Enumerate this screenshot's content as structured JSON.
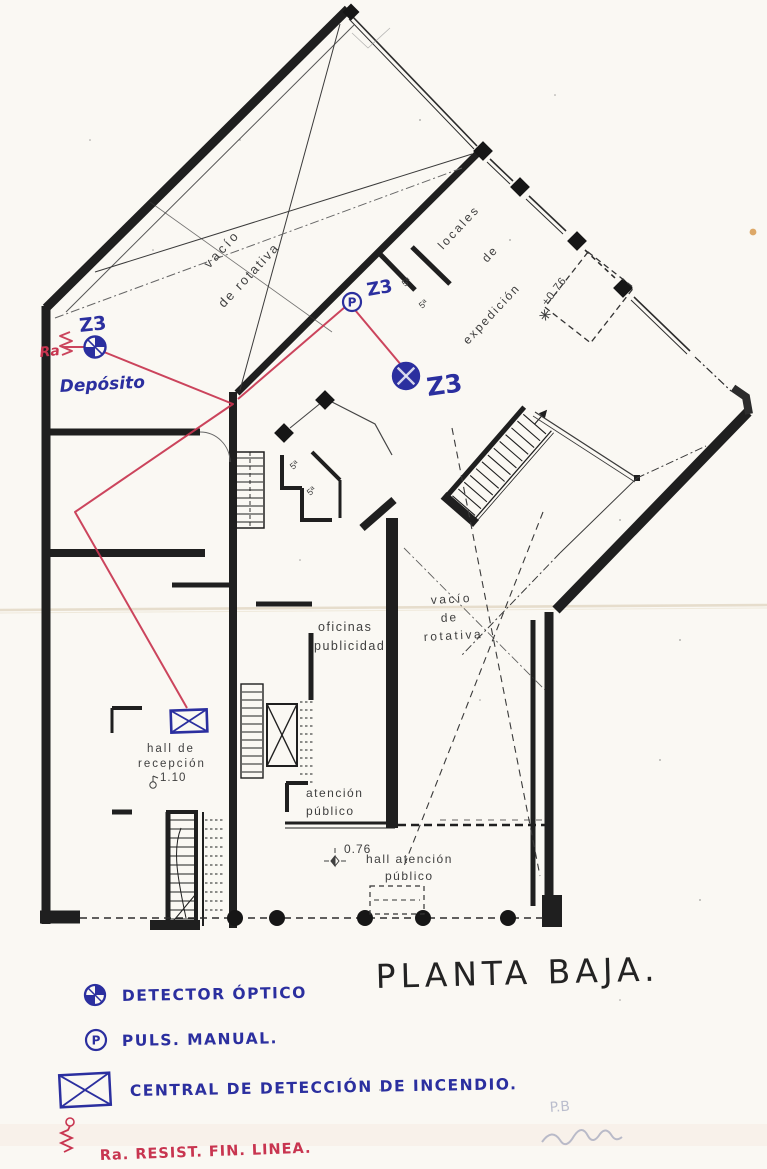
{
  "document": {
    "title": "PLANTA BAJA.",
    "pencil_note": "P.B"
  },
  "rooms": {
    "rotary_void_top": {
      "line1": "vacío",
      "line2": "de rotativa"
    },
    "expedition": {
      "line1": "locales",
      "line2": "de",
      "line3": "expedición",
      "level": "+0.76"
    },
    "advertising_offices": {
      "line1": "oficinas",
      "line2": "publicidad"
    },
    "rotary_void_right": {
      "line1": "vacío",
      "line2": "de",
      "line3": "rotativa"
    },
    "reception_hall": {
      "line1": "hall de",
      "line2": "recepción",
      "level": "1.10"
    },
    "public_attention": {
      "line1": "atención",
      "line2": "público"
    },
    "public_attention_hall": {
      "line1": "hall atención",
      "line2": "público",
      "level": "0.76"
    },
    "room_tags": [
      "5ª",
      "5ª",
      "5ª",
      "5ª"
    ]
  },
  "annotations": {
    "zone_detector_deposito": "Z3",
    "zone_callpoint": "Z3",
    "zone_detector_main": "Z3",
    "deposito_label": "Depósito",
    "resistor_tag": "Ra",
    "callpoint_letter": "P"
  },
  "legend": {
    "title_items": [
      {
        "symbol": "optical-detector-icon",
        "label": "DETECTOR ÓPTICO"
      },
      {
        "symbol": "manual-callpoint-icon",
        "label": "PULS. MANUAL."
      },
      {
        "symbol": "fire-panel-icon",
        "label": "CENTRAL DE DETECCIÓN DE INCENDIO."
      },
      {
        "symbol": "end-of-line-resistor-icon",
        "label": "Ra. RESIST. FIN. LINEA."
      }
    ],
    "callpoint_letter": "P"
  },
  "colors": {
    "ink_blue": "#2b2f9f",
    "wire_red": "#c83550",
    "wall_black": "#1f1f1f",
    "paper": "#faf8f3",
    "pencil": "#7b84a8"
  }
}
